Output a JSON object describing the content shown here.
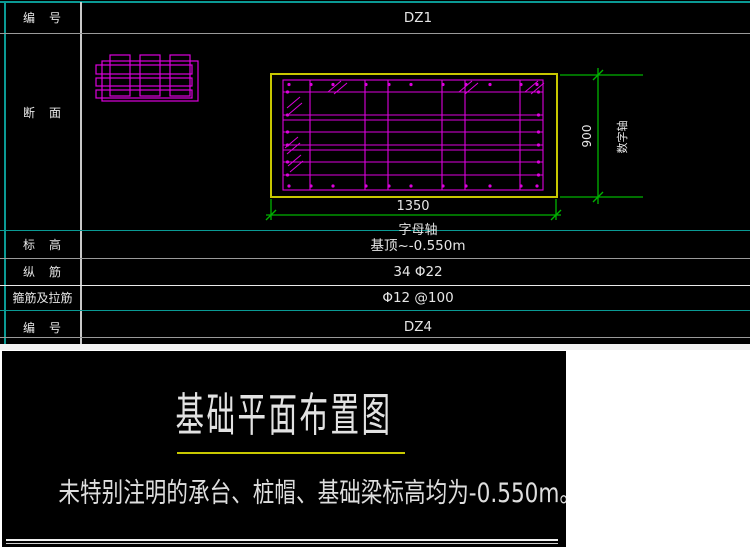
{
  "table": {
    "rows": [
      {
        "label": "编　号",
        "value": "DZ1"
      },
      {
        "label": "断　面",
        "value": ""
      },
      {
        "label": "标　高",
        "value": "基顶~-0.550m"
      },
      {
        "label": "纵　筋",
        "value": "34 Φ22"
      },
      {
        "label": "箍筋及拉筋",
        "value": "Φ12 @100"
      },
      {
        "label": "编　号",
        "value": "DZ4"
      }
    ]
  },
  "drawing": {
    "dim_width": "1350",
    "dim_height": "900",
    "axis_bottom_label": "字母轴",
    "axis_right_label": "数字轴"
  },
  "footer": {
    "title": "基础平面布置图",
    "note": "未特别注明的承台、桩帽、基础梁标高均为-0.550m。"
  },
  "colors": {
    "background": "#000000",
    "page": "#ffffff",
    "teal_line": "#0a9a94",
    "gray_line": "#9a9a9a",
    "rebar_magenta": "#dd00dd",
    "outline_yellow": "#c8c800",
    "dimension_green": "#00b400",
    "text_white": "#e6e6e6"
  }
}
